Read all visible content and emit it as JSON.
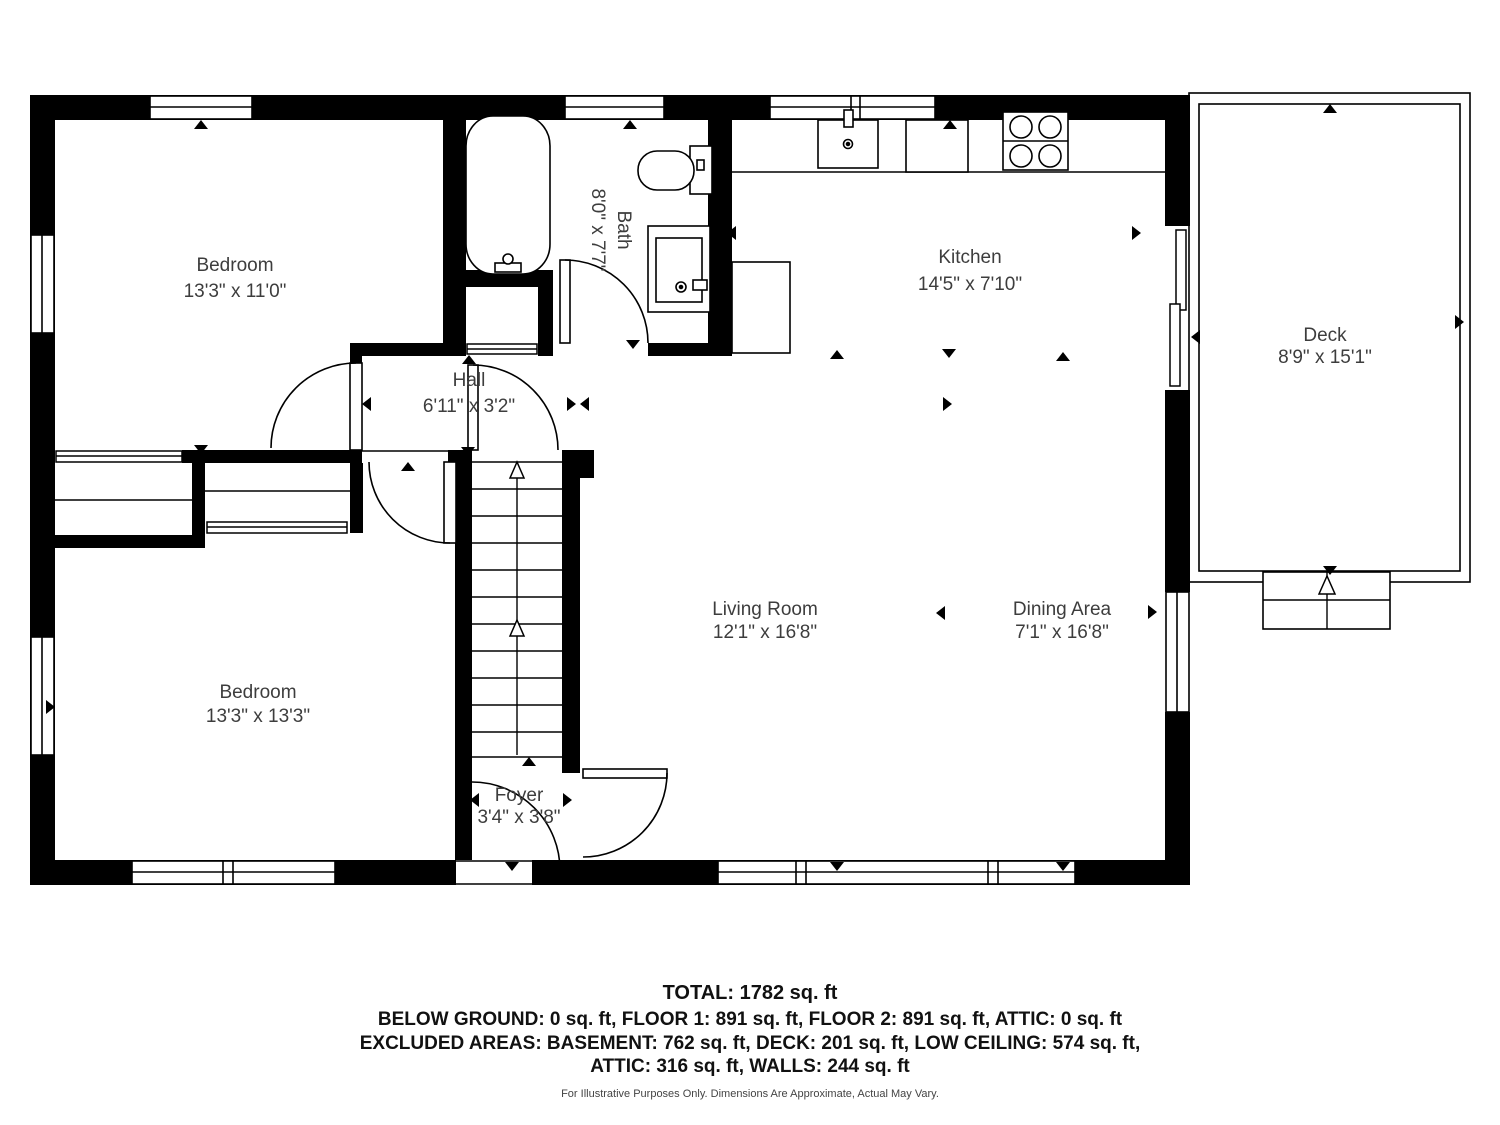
{
  "rooms": [
    {
      "name": "Bedroom",
      "dims": "13'3\" x 11'0\""
    },
    {
      "name": "Bath",
      "dims": "8'0\" x 7'7\""
    },
    {
      "name": "Kitchen",
      "dims": "14'5\" x 7'10\""
    },
    {
      "name": "Deck",
      "dims": "8'9\" x 15'1\""
    },
    {
      "name": "Hall",
      "dims": "6'11\" x 3'2\""
    },
    {
      "name": "Living Room",
      "dims": "12'1\" x 16'8\""
    },
    {
      "name": "Dining Area",
      "dims": "7'1\" x 16'8\""
    },
    {
      "name": "Bedroom",
      "dims": "13'3\" x 13'3\""
    },
    {
      "name": "Foyer",
      "dims": "3'4\" x 3'8\""
    }
  ],
  "summary": {
    "total": "TOTAL: 1782 sq. ft",
    "line1": "BELOW GROUND: 0 sq. ft, FLOOR 1: 891 sq. ft, FLOOR 2: 891 sq. ft, ATTIC: 0 sq. ft",
    "line2": "EXCLUDED AREAS: BASEMENT: 762 sq. ft, DECK: 201 sq. ft, LOW CEILING: 574 sq. ft,",
    "line3": "ATTIC: 316 sq. ft, WALLS: 244 sq. ft",
    "disclaimer": "For Illustrative Purposes Only. Dimensions Are Approximate, Actual May Vary."
  },
  "colors": {
    "wall": "#000000",
    "label": "#3d3d3d",
    "background": "#ffffff"
  }
}
